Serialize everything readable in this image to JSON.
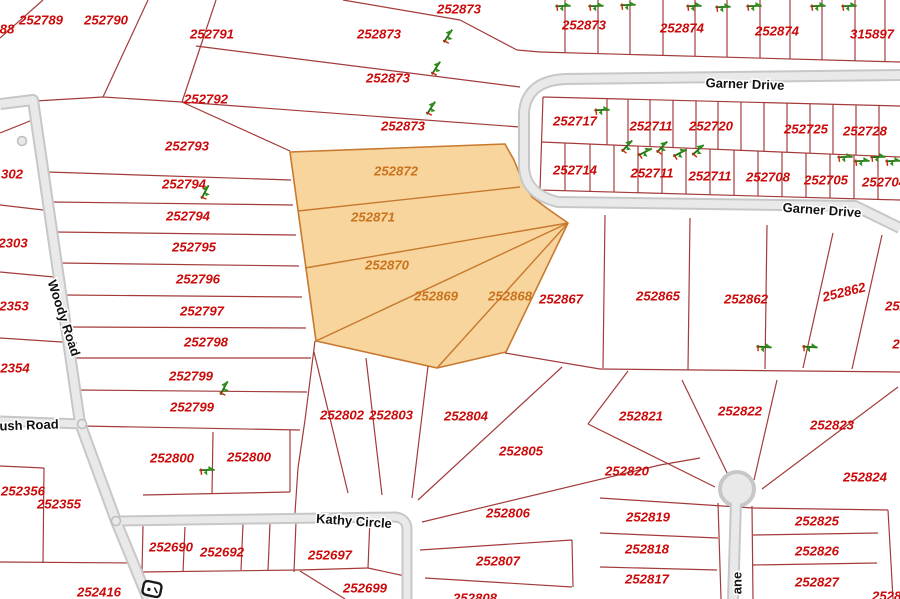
{
  "map": {
    "background": "#ffffff",
    "parcel_line_color": "#a33b3b",
    "parcel_label_color": "#cc0a0a",
    "highlight_fill": "#f7d59c",
    "highlight_stroke": "#c8782f",
    "highlight_label_color": "#ca731c",
    "road_outer_color": "#c7c7c7",
    "road_inner_color": "#e9e9e9",
    "road_label_color": "#111111",
    "tree_color": "#2f8f1a",
    "parcel_font_size": 13.2,
    "road_font_size": 13
  },
  "highlight": {
    "selected_parcels": [
      "252872",
      "252871",
      "252870",
      "252869",
      "252868"
    ],
    "polygon": "290,152 505,144 514,160 522,180 532,197 548,209 568,223 506,352 437,368 316,341",
    "dividers": [
      [
        298,
        211,
        520,
        187
      ],
      [
        305,
        268,
        568,
        223
      ],
      [
        316,
        341,
        568,
        223
      ],
      [
        437,
        368,
        568,
        223
      ]
    ]
  },
  "parcel_labels": [
    {
      "text": "88",
      "x": 7,
      "y": 29
    },
    {
      "text": "252789",
      "x": 41,
      "y": 20
    },
    {
      "text": "252790",
      "x": 106,
      "y": 20
    },
    {
      "text": "252791",
      "x": 212,
      "y": 34
    },
    {
      "text": "252792",
      "x": 206,
      "y": 99
    },
    {
      "text": "252793",
      "x": 187,
      "y": 146
    },
    {
      "text": "252794",
      "x": 184,
      "y": 184
    },
    {
      "text": "252794",
      "x": 188,
      "y": 216
    },
    {
      "text": "252795",
      "x": 194,
      "y": 247
    },
    {
      "text": "252796",
      "x": 198,
      "y": 279
    },
    {
      "text": "252797",
      "x": 202,
      "y": 311
    },
    {
      "text": "252798",
      "x": 206,
      "y": 342
    },
    {
      "text": "252799",
      "x": 191,
      "y": 376
    },
    {
      "text": "252799",
      "x": 192,
      "y": 407
    },
    {
      "text": "252800",
      "x": 172,
      "y": 458
    },
    {
      "text": "252800",
      "x": 249,
      "y": 457
    },
    {
      "text": "302",
      "x": 12,
      "y": 174
    },
    {
      "text": "2303",
      "x": 13,
      "y": 243
    },
    {
      "text": "2353",
      "x": 14,
      "y": 306
    },
    {
      "text": "2354",
      "x": 15,
      "y": 368
    },
    {
      "text": "252356",
      "x": 23,
      "y": 491
    },
    {
      "text": "252355",
      "x": 59,
      "y": 504
    },
    {
      "text": "252416",
      "x": 99,
      "y": 592
    },
    {
      "text": "252690",
      "x": 171,
      "y": 547
    },
    {
      "text": "252692",
      "x": 222,
      "y": 552
    },
    {
      "text": "252697",
      "x": 330,
      "y": 555
    },
    {
      "text": "252699",
      "x": 365,
      "y": 588
    },
    {
      "text": "252802",
      "x": 342,
      "y": 415
    },
    {
      "text": "252803",
      "x": 391,
      "y": 415
    },
    {
      "text": "252804",
      "x": 466,
      "y": 416
    },
    {
      "text": "252805",
      "x": 521,
      "y": 451
    },
    {
      "text": "252806",
      "x": 508,
      "y": 513
    },
    {
      "text": "252807",
      "x": 498,
      "y": 561
    },
    {
      "text": "252808",
      "x": 475,
      "y": 598
    },
    {
      "text": "252867",
      "x": 561,
      "y": 299
    },
    {
      "text": "252865",
      "x": 658,
      "y": 296
    },
    {
      "text": "252862",
      "x": 746,
      "y": 299
    },
    {
      "text": "252862",
      "x": 844,
      "y": 292,
      "rot": -14
    },
    {
      "text": "252",
      "x": 896,
      "y": 306
    },
    {
      "text": "2",
      "x": 896,
      "y": 344
    },
    {
      "text": "252821",
      "x": 641,
      "y": 416
    },
    {
      "text": "252822",
      "x": 740,
      "y": 411
    },
    {
      "text": "252823",
      "x": 832,
      "y": 425
    },
    {
      "text": "252820",
      "x": 627,
      "y": 471
    },
    {
      "text": "252824",
      "x": 865,
      "y": 477
    },
    {
      "text": "252819",
      "x": 648,
      "y": 517
    },
    {
      "text": "252825",
      "x": 817,
      "y": 521
    },
    {
      "text": "252818",
      "x": 647,
      "y": 549
    },
    {
      "text": "252826",
      "x": 817,
      "y": 551
    },
    {
      "text": "252817",
      "x": 647,
      "y": 579
    },
    {
      "text": "252827",
      "x": 817,
      "y": 582
    },
    {
      "text": "252828",
      "x": 894,
      "y": 596
    },
    {
      "text": "252873",
      "x": 459,
      "y": 9
    },
    {
      "text": "252873",
      "x": 379,
      "y": 34
    },
    {
      "text": "252873",
      "x": 388,
      "y": 78
    },
    {
      "text": "252873",
      "x": 403,
      "y": 126
    },
    {
      "text": "252873",
      "x": 584,
      "y": 25
    },
    {
      "text": "252874",
      "x": 682,
      "y": 28
    },
    {
      "text": "252874",
      "x": 777,
      "y": 31
    },
    {
      "text": "315897",
      "x": 872,
      "y": 34
    },
    {
      "text": "252717",
      "x": 575,
      "y": 121
    },
    {
      "text": "252711",
      "x": 651,
      "y": 126
    },
    {
      "text": "252720",
      "x": 711,
      "y": 126
    },
    {
      "text": "252725",
      "x": 806,
      "y": 129
    },
    {
      "text": "252728",
      "x": 865,
      "y": 131
    },
    {
      "text": "252714",
      "x": 575,
      "y": 170
    },
    {
      "text": "252711",
      "x": 652,
      "y": 173
    },
    {
      "text": "252711",
      "x": 710,
      "y": 176
    },
    {
      "text": "252708",
      "x": 768,
      "y": 177
    },
    {
      "text": "252705",
      "x": 826,
      "y": 180
    },
    {
      "text": "252704",
      "x": 884,
      "y": 182
    },
    {
      "text": "252872",
      "x": 396,
      "y": 171,
      "hl": true
    },
    {
      "text": "252871",
      "x": 373,
      "y": 217,
      "hl": true
    },
    {
      "text": "252870",
      "x": 387,
      "y": 265,
      "hl": true
    },
    {
      "text": "252869",
      "x": 436,
      "y": 296,
      "hl": true
    },
    {
      "text": "252868",
      "x": 510,
      "y": 296,
      "hl": true
    }
  ],
  "road_labels": [
    {
      "text": "Garner Drive",
      "x": 745,
      "y": 84,
      "rot": 2
    },
    {
      "text": "Garner Drive",
      "x": 822,
      "y": 210,
      "rot": 4
    },
    {
      "text": "Woody Road",
      "x": 64,
      "y": 318,
      "rot": 72
    },
    {
      "text": "ush Road",
      "x": 29,
      "y": 425,
      "rot": -2
    },
    {
      "text": "Kathy Circle",
      "x": 354,
      "y": 521,
      "rot": 4
    },
    {
      "text": "ane",
      "x": 737,
      "y": 583,
      "rot": -90
    }
  ],
  "roads": [
    {
      "d": "M0,104 L33,100 L80,423 L116,521 L148,599",
      "w": 12
    },
    {
      "d": "M0,421 L82,424",
      "w": 11
    },
    {
      "d": "M116,521 L395,517 Q406,518 407,528 L407,599",
      "w": 11
    },
    {
      "d": "M900,75 L565,79 Q527,81 524,112 L524,165 Q524,194 558,202 L855,206 L900,228",
      "w": 12
    },
    {
      "d": "M736,502 L733,599",
      "w": 12
    }
  ],
  "culdesac": {
    "cx": 737,
    "cy": 489,
    "r": 17
  },
  "junction_dots": [
    [
      82,
      424
    ],
    [
      116,
      521
    ],
    [
      22,
      141
    ]
  ],
  "trees": [
    [
      563,
      6,
      65
    ],
    [
      596,
      6,
      65
    ],
    [
      628,
      5,
      65
    ],
    [
      694,
      6,
      65
    ],
    [
      723,
      7,
      65
    ],
    [
      754,
      6,
      65
    ],
    [
      818,
      6,
      65
    ],
    [
      849,
      6,
      65
    ],
    [
      448,
      36,
      10
    ],
    [
      436,
      68,
      10
    ],
    [
      431,
      108,
      10
    ],
    [
      602,
      110,
      65
    ],
    [
      627,
      146,
      20
    ],
    [
      645,
      152,
      40
    ],
    [
      662,
      147,
      20
    ],
    [
      680,
      153,
      40
    ],
    [
      698,
      150,
      25
    ],
    [
      845,
      157,
      65
    ],
    [
      862,
      161,
      65
    ],
    [
      878,
      157,
      65
    ],
    [
      893,
      161,
      65
    ],
    [
      205,
      192,
      5
    ],
    [
      224,
      388,
      5
    ],
    [
      207,
      470,
      65
    ],
    [
      764,
      347,
      70
    ],
    [
      810,
      347,
      70
    ]
  ],
  "shield_icon": {
    "x": 152,
    "y": 589,
    "rot": 12
  },
  "lines": [
    [
      43,
      0,
      0,
      38
    ],
    [
      148,
      0,
      103,
      97
    ],
    [
      103,
      97,
      35,
      101
    ],
    [
      216,
      0,
      182,
      102
    ],
    [
      103,
      97,
      182,
      102
    ],
    [
      182,
      102,
      290,
      151
    ],
    [
      196,
      46,
      520,
      87
    ],
    [
      182,
      102,
      520,
      127
    ],
    [
      343,
      0,
      460,
      20
    ],
    [
      460,
      20,
      517,
      50
    ],
    [
      517,
      50,
      540,
      52
    ],
    [
      540,
      52,
      900,
      62
    ],
    [
      565,
      0,
      565,
      53
    ],
    [
      598,
      0,
      598,
      54
    ],
    [
      630,
      0,
      630,
      55
    ],
    [
      663,
      0,
      663,
      55
    ],
    [
      695,
      0,
      695,
      56
    ],
    [
      727,
      0,
      727,
      57
    ],
    [
      760,
      0,
      760,
      58
    ],
    [
      790,
      0,
      790,
      59
    ],
    [
      822,
      0,
      822,
      60
    ],
    [
      855,
      0,
      855,
      61
    ],
    [
      885,
      0,
      885,
      62
    ],
    [
      47,
      172,
      291,
      180
    ],
    [
      51,
      202,
      293,
      205
    ],
    [
      55,
      232,
      296,
      235
    ],
    [
      59,
      263,
      299,
      266
    ],
    [
      63,
      295,
      302,
      297
    ],
    [
      67,
      327,
      306,
      328
    ],
    [
      72,
      358,
      311,
      358
    ],
    [
      76,
      390,
      307,
      392
    ],
    [
      82,
      426,
      300,
      430
    ],
    [
      315,
      341,
      305,
      420
    ],
    [
      305,
      420,
      298,
      468
    ],
    [
      298,
      468,
      295,
      513
    ],
    [
      143,
      495,
      290,
      492
    ],
    [
      213,
      432,
      212,
      494
    ],
    [
      290,
      430,
      290,
      492
    ],
    [
      0,
      205,
      52,
      211
    ],
    [
      0,
      272,
      65,
      278
    ],
    [
      0,
      338,
      77,
      343
    ],
    [
      0,
      133,
      40,
      117
    ],
    [
      0,
      466,
      44,
      468
    ],
    [
      44,
      468,
      43,
      563
    ],
    [
      0,
      562,
      138,
      563
    ],
    [
      138,
      563,
      142,
      599
    ],
    [
      143,
      526,
      142,
      572
    ],
    [
      185,
      527,
      183,
      572
    ],
    [
      243,
      524,
      241,
      570
    ],
    [
      270,
      523,
      268,
      571
    ],
    [
      296,
      522,
      294,
      572
    ],
    [
      370,
      518,
      368,
      568
    ],
    [
      142,
      572,
      300,
      570
    ],
    [
      300,
      570,
      368,
      568
    ],
    [
      300,
      571,
      345,
      599
    ],
    [
      368,
      568,
      405,
      576
    ],
    [
      314,
      352,
      348,
      493
    ],
    [
      366,
      358,
      382,
      495
    ],
    [
      428,
      366,
      412,
      498
    ],
    [
      562,
      367,
      418,
      500
    ],
    [
      505,
      353,
      600,
      369
    ],
    [
      600,
      369,
      900,
      372
    ],
    [
      605,
      215,
      603,
      368
    ],
    [
      690,
      218,
      688,
      370
    ],
    [
      767,
      225,
      765,
      369
    ],
    [
      833,
      233,
      803,
      368
    ],
    [
      882,
      235,
      852,
      369
    ],
    [
      628,
      371,
      588,
      424
    ],
    [
      588,
      424,
      715,
      487
    ],
    [
      682,
      380,
      729,
      477
    ],
    [
      777,
      380,
      754,
      480
    ],
    [
      898,
      387,
      762,
      489
    ],
    [
      600,
      498,
      753,
      508
    ],
    [
      753,
      508,
      888,
      510
    ],
    [
      600,
      533,
      718,
      538
    ],
    [
      753,
      535,
      878,
      533
    ],
    [
      600,
      567,
      717,
      570
    ],
    [
      752,
      565,
      877,
      563
    ],
    [
      718,
      503,
      721,
      599
    ],
    [
      752,
      506,
      753,
      599
    ],
    [
      888,
      510,
      893,
      599
    ],
    [
      422,
      522,
      660,
      465
    ],
    [
      660,
      465,
      700,
      458
    ],
    [
      420,
      550,
      572,
      540
    ],
    [
      572,
      540,
      573,
      587
    ],
    [
      425,
      578,
      572,
      587
    ],
    [
      543,
      97,
      900,
      106
    ],
    [
      541,
      142,
      900,
      157
    ],
    [
      540,
      190,
      900,
      200
    ],
    [
      543,
      97,
      540,
      190
    ],
    [
      607,
      99,
      607,
      145
    ],
    [
      628,
      99,
      628,
      146
    ],
    [
      650,
      100,
      650,
      147
    ],
    [
      673,
      100,
      673,
      148
    ],
    [
      696,
      101,
      696,
      148
    ],
    [
      718,
      101,
      718,
      149
    ],
    [
      741,
      102,
      741,
      150
    ],
    [
      764,
      103,
      764,
      151
    ],
    [
      787,
      103,
      787,
      152
    ],
    [
      810,
      104,
      810,
      153
    ],
    [
      833,
      104,
      833,
      154
    ],
    [
      856,
      105,
      856,
      155
    ],
    [
      879,
      105,
      879,
      156
    ],
    [
      565,
      143,
      565,
      191
    ],
    [
      590,
      144,
      590,
      191
    ],
    [
      614,
      145,
      614,
      192
    ],
    [
      638,
      146,
      638,
      193
    ],
    [
      662,
      147,
      662,
      193
    ],
    [
      686,
      148,
      686,
      194
    ],
    [
      710,
      149,
      710,
      195
    ],
    [
      734,
      150,
      734,
      195
    ],
    [
      758,
      151,
      758,
      196
    ],
    [
      782,
      152,
      782,
      197
    ],
    [
      806,
      153,
      806,
      197
    ],
    [
      830,
      154,
      830,
      198
    ],
    [
      854,
      155,
      854,
      199
    ],
    [
      878,
      156,
      878,
      199
    ]
  ]
}
